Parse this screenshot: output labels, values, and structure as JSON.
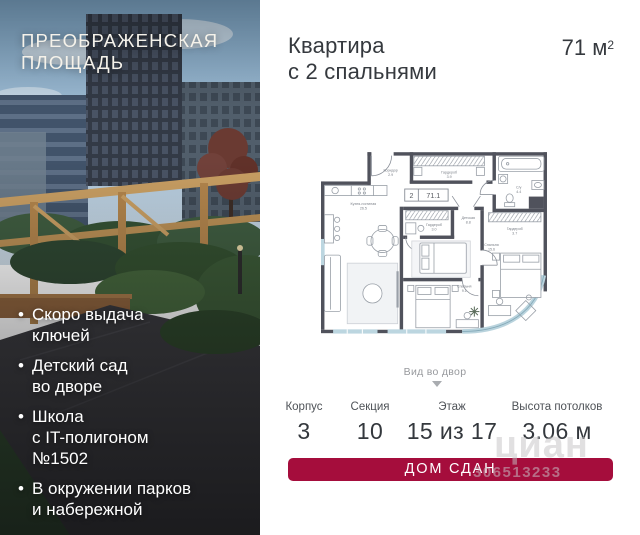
{
  "left_panel": {
    "title_line1": "ПРЕОБРАЖЕНСКАЯ",
    "title_line2": "ПЛОЩАДЬ",
    "bullets": [
      "Скоро выдача\nключей",
      "Детский сад\nво дворе",
      "Школа\nс IT-полигоном\n№1502",
      "В окружении парков\nи набережной"
    ]
  },
  "header": {
    "title_line1": "Квартира",
    "title_line2": "с 2 спальнями",
    "area_value": "71",
    "area_unit": "м",
    "area_exponent": "2"
  },
  "plan": {
    "view_label": "Вид во двор",
    "badge": {
      "rooms": "2",
      "area": "71.1"
    },
    "rooms": {
      "corridor_name": "Коридор",
      "corridor_area": "2.9",
      "wardrobe_top_name": "Гардероб",
      "wardrobe_top_area": "3.9",
      "bathroom_name": "С/у",
      "bathroom_area": "4.4",
      "kitchen_name": "Кухня-гостиная",
      "kitchen_area": "26.5",
      "wardrobe_mid_name": "Гардероб",
      "wardrobe_mid_area": "3.0",
      "nursery_name": "Детская",
      "nursery_area": "8.8",
      "bedroom_mid_name": "Спальня",
      "bedroom_mid_area": "9.1",
      "wardrobe_right_name": "Гардероб",
      "wardrobe_right_area": "3.7",
      "bedroom_right_name": "Спальня",
      "bedroom_right_area": "15.6"
    }
  },
  "stats": {
    "items": [
      {
        "label": "Корпус",
        "value": "3"
      },
      {
        "label": "Секция",
        "value": "10"
      },
      {
        "label": "Этаж",
        "value": "15 из 17"
      },
      {
        "label": "Высота потолков",
        "value": "3.06 м"
      }
    ]
  },
  "banner": {
    "label": "ДОМ СДАН",
    "color": "#a50d3c"
  },
  "watermark": {
    "brand": "циан",
    "id": "306513233"
  },
  "colors": {
    "accent": "#a50d3c",
    "plan_walls": "#50525c",
    "glazing": "#bcd6e0"
  }
}
